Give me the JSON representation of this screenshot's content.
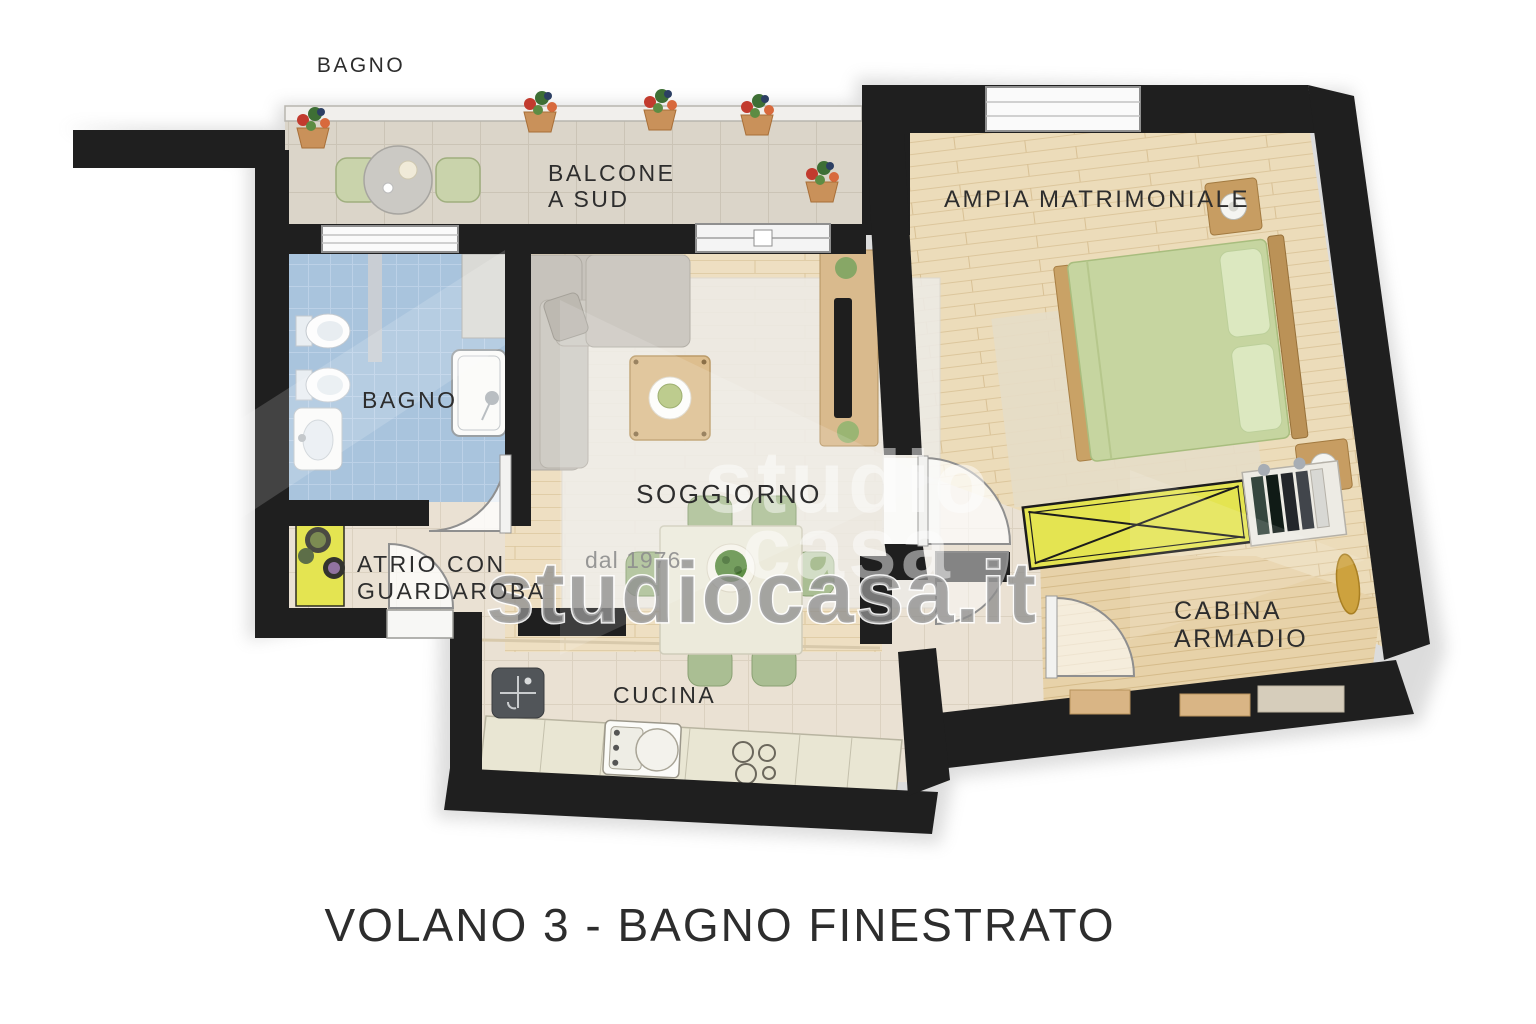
{
  "plan": {
    "labels": {
      "balcony_bath_note": "BAGNO",
      "balcony_line1": "BALCONE",
      "balcony_line2": "A SUD",
      "bedroom": "AMPIA MATRIMONIALE",
      "bathroom": "BAGNO",
      "living": "SOGGIORNO",
      "atrium_line1": "ATRIO CON",
      "atrium_line2": "GUARDAROBA",
      "closet_line1": "CABINA",
      "closet_line2": "ARMADIO",
      "kitchen": "CUCINA"
    },
    "caption": "VOLANO 3 - BAGNO FINESTRATO",
    "watermark": {
      "brand_line1": "studio",
      "brand_line2": "casa",
      "tagline": "dal 1976",
      "url": "studiocasa.it"
    },
    "colors": {
      "wall": "#1f1f1f",
      "wood_living": "#eedfc2",
      "wood_bedroom": "#ecdcba",
      "wood_closet": "#e7d2a9",
      "tile_beige": "#eae1d3",
      "tile_blue": "#a9c4dd",
      "tile_balcony": "#dbd5c9",
      "accent_yellow": "#e4e451",
      "bed_green": "#c6d5a0",
      "chair_green": "#aabe93",
      "sofa_gray": "#c7c3bc",
      "counter_cream": "#e9e6d3",
      "label_text": "#2d2d2d",
      "watermark_gray": "#8f8f8f"
    }
  }
}
